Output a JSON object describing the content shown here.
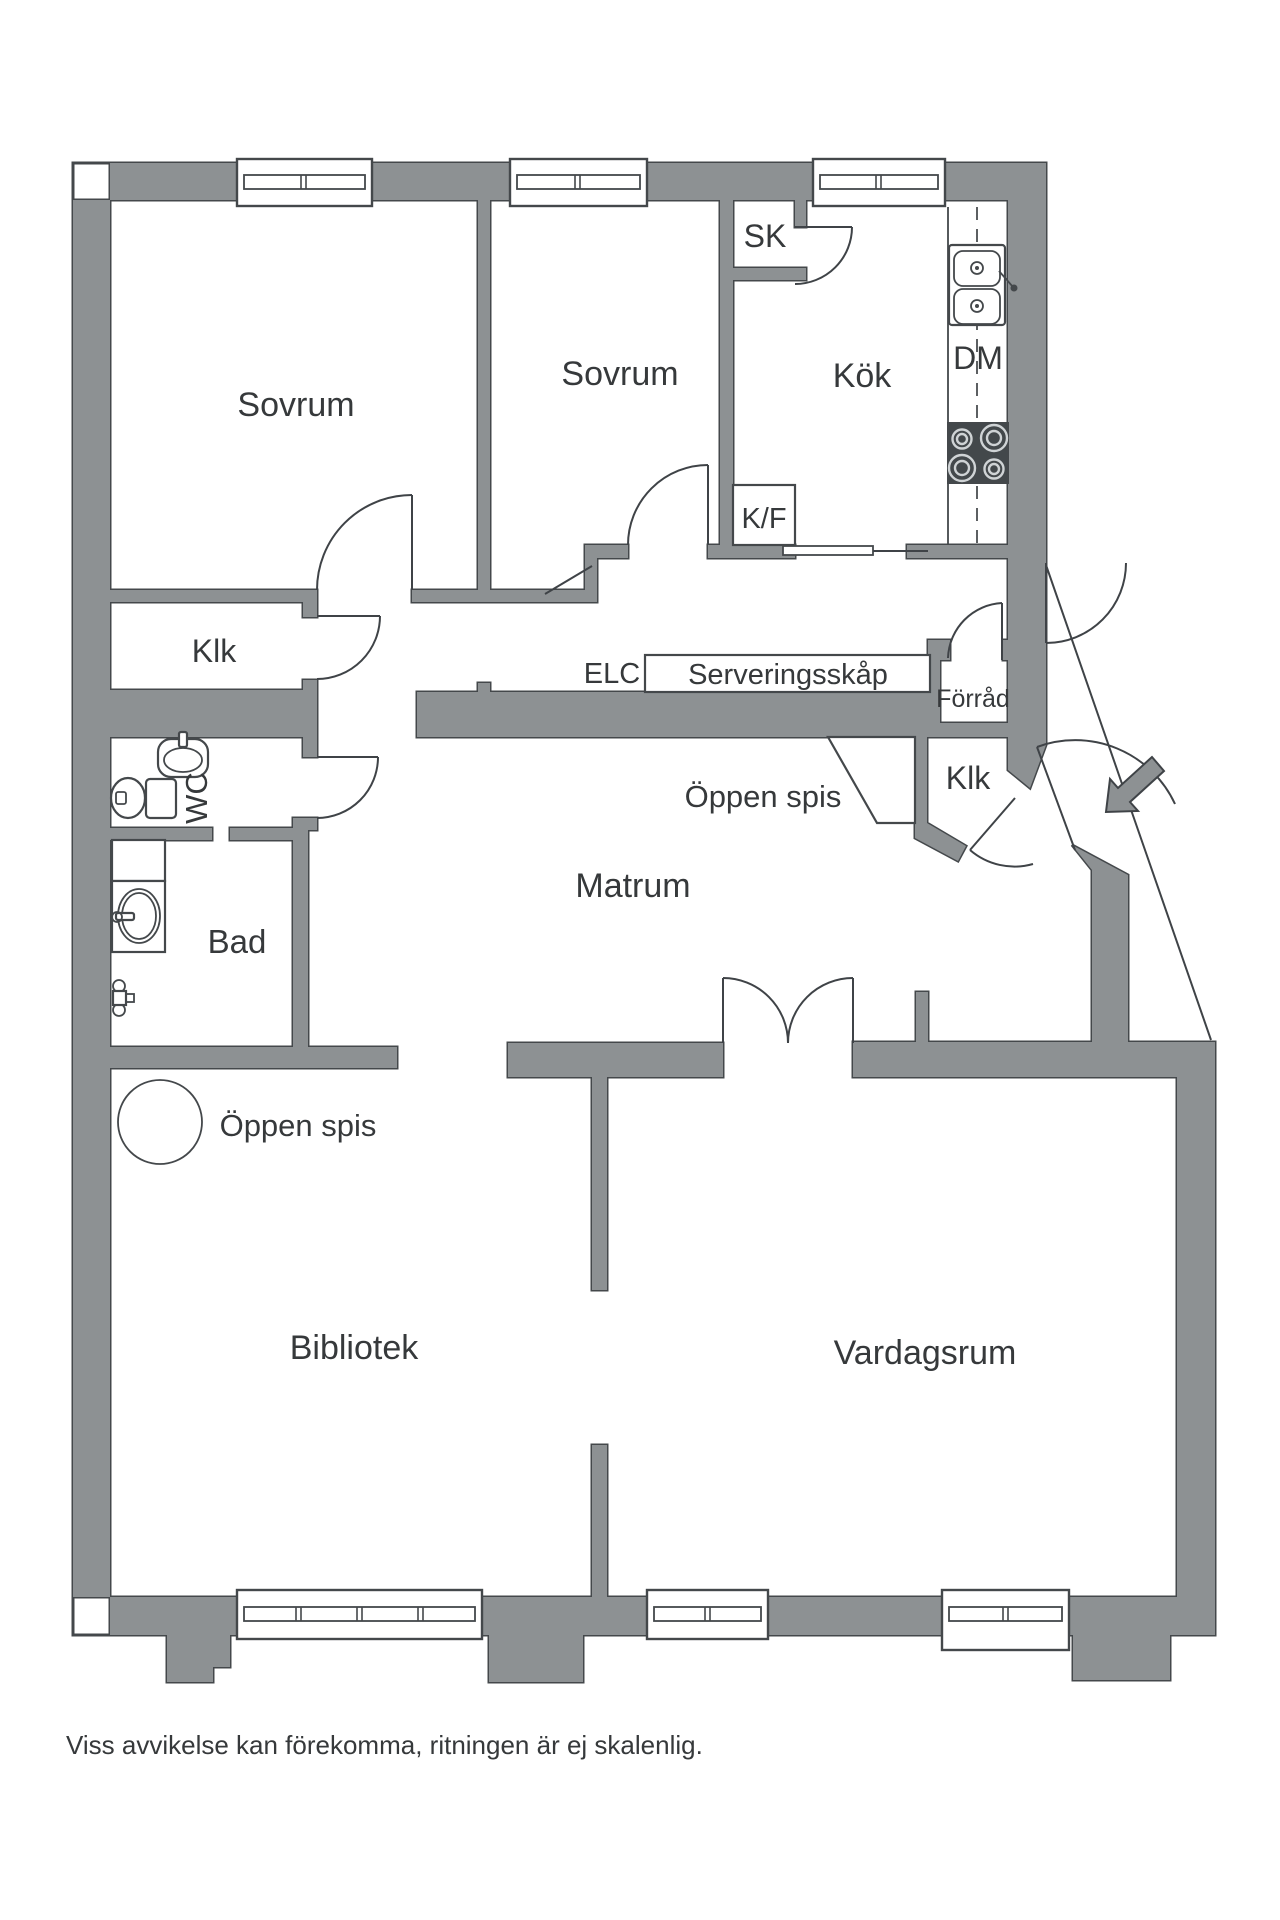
{
  "floorplan": {
    "labels": {
      "sovrum_1": "Sovrum",
      "sovrum_2": "Sovrum",
      "kok": "Kök",
      "sk": "SK",
      "dm": "DM",
      "kf": "K/F",
      "klk_hall": "Klk",
      "elc": "ELC",
      "serveringsskap": "Serveringsskåp",
      "forrad": "Förråd",
      "oppen_spis_matrum": "Öppen spis",
      "klk_entry": "Klk",
      "wc": "WC",
      "matrum": "Matrum",
      "bad": "Bad",
      "oppen_spis_bibliotek": "Öppen spis",
      "bibliotek": "Bibliotek",
      "vardagsrum": "Vardagsrum",
      "disclaimer": "Viss avvikelse kan förekomma, ritningen är ej skalenlig."
    },
    "colors": {
      "wall": "#8d9193",
      "outline": "#44484b",
      "ink": "#36393b",
      "stove": "#43484b",
      "burner": "#cfd3d5"
    }
  }
}
